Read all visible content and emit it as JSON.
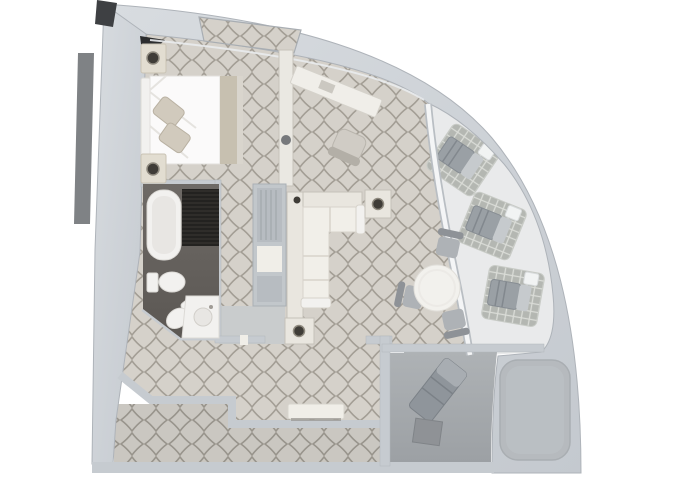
{
  "page": {
    "title": "Curved corner suite floor plan (top-down 3D render)",
    "width": 680,
    "height": 486
  },
  "colors": {
    "background": "#ffffff",
    "hull_light": "#d8dce0",
    "hull_dark": "#c4c9cf",
    "hull_edge": "#aeb3b9",
    "wall": "#c6cbd0",
    "wall_dark": "#3e4043",
    "side_strip": "#7f8285",
    "corner_dark": "#2c2d2e",
    "carpet_base": "#d5d1ca",
    "carpet_line": "#a39e95",
    "corridor_base": "#cac7c1",
    "corridor_line": "#98948c",
    "deck": "#e9eaeb",
    "lattice_base": "#b4b7b2",
    "lattice_line": "#dadcd7",
    "glass": "#f4f5f6",
    "glass_edge": "#b9bec3",
    "bath_floor_light": "#6e6a66",
    "bath_floor_dark": "#5b5753",
    "fixture": "#f2f1ef",
    "fixture_shadow": "#dcdad6",
    "fixture_inner": "#e8e6e3",
    "shower": "#2f2d2a",
    "shower_line": "#1b1a18",
    "bed": "#fbfafa",
    "bed_fold": "#e5e3df",
    "pillow": "#d1cabd",
    "pillow_edge": "#b9b1a2",
    "runner": "#c7c0b0",
    "footboard": "#d9d5cd",
    "stand": "#e2ddd1",
    "stand_edge": "#c9c3b4",
    "lamp": "#3f3c37",
    "lamp_ring": "#8f8a7f",
    "partition": "#eae8e2",
    "partition_dot": "#77797c",
    "closet": "#c2c7cb",
    "closet_inner": "#b7bcc1",
    "closet_line": "#9da3a8",
    "vestibule": "#c9cccd",
    "sofa_frame": "#e9e6df",
    "sofa_seat": "#f1efe9",
    "sofa_line": "#d7d3cb",
    "sofa_edge": "#c5c1b9",
    "desk": "#f0eee9",
    "desk_item": "#cbc8c1",
    "chair_seat": "#d0ccc5",
    "chair_back": "#b3afa7",
    "table": "#f2f1ed",
    "table_ring": "#eceae6",
    "dining_chair": "#aeb2b6",
    "dining_chair_back": "#8e9297",
    "lounger": "#9aa0a5",
    "lounger_dark": "#82888e",
    "lounger_pad": "#c6cacd",
    "deck_table": "#f1f3f3",
    "terrace_light": "#aeb2b5",
    "terrace_dark": "#9ca0a4",
    "terrace_lounger": "#8f959b",
    "terrace_lounger_pad": "#a8adb2",
    "terrace_table": "#8f9296",
    "hot_tub": "#b6babe",
    "hot_tub_inner": "#bcc0c4",
    "console": "#f0eee8",
    "console_shadow": "#8e8b86"
  },
  "floor_plan": {
    "shape": "quarter-circle curved hull suite",
    "rooms": [
      {
        "id": "bedroom",
        "furniture": [
          "double-bed",
          "pillows",
          "nightstand-with-lamp",
          "nightstand-with-lamp"
        ]
      },
      {
        "id": "bathroom",
        "furniture": [
          "bathtub",
          "shower",
          "toilet",
          "bidet",
          "sink-vanity"
        ]
      },
      {
        "id": "hallway",
        "furniture": [
          "closet-wardrobe"
        ]
      },
      {
        "id": "living-room",
        "furniture": [
          "desk",
          "desk-chair",
          "l-shaped-sofa",
          "side-table-with-lamp",
          "side-table-with-lamp",
          "console-sideboard"
        ]
      },
      {
        "id": "dining-area",
        "furniture": [
          "round-dining-table",
          "dining-chair",
          "dining-chair",
          "dining-chair"
        ]
      },
      {
        "id": "balcony-curved",
        "furniture": [
          "deck-mat",
          "sun-lounger",
          "drinks-table",
          "deck-mat",
          "sun-lounger",
          "drinks-table",
          "deck-mat",
          "sun-lounger",
          "drinks-table"
        ]
      },
      {
        "id": "private-terrace",
        "furniture": [
          "sun-lounger",
          "square-table",
          "hot-tub"
        ]
      },
      {
        "id": "corridor",
        "furniture": []
      }
    ]
  }
}
